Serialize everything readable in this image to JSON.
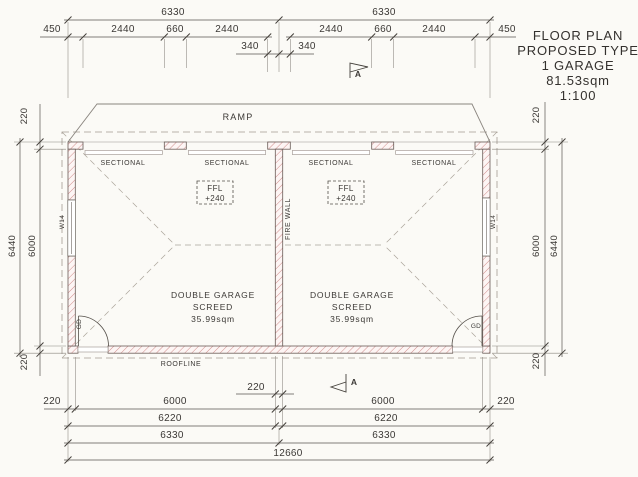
{
  "title_block": {
    "lines": [
      "FLOOR PLAN",
      "PROPOSED TYPE",
      "1 GARAGE",
      "81.53sqm",
      "1:100"
    ]
  },
  "plan": {
    "ramp": "RAMP",
    "roofline": "ROOFLINE",
    "sectional": "SECTIONAL",
    "firewall": "FIRE WALL",
    "ffl": "FFL",
    "ffl_value": "+240",
    "garage_name": "DOUBLE GARAGE",
    "screed": "SCREED",
    "area": "35.99sqm",
    "window": "W14",
    "door": "GD",
    "marker": "A"
  },
  "dims": {
    "top": {
      "r1_left": "6330",
      "r1_right": "6330",
      "r2": [
        "450",
        "2440",
        "660",
        "2440",
        "2440",
        "660",
        "2440",
        "450"
      ],
      "r3_left": "340",
      "r3_right": "340"
    },
    "left": {
      "t220": "220",
      "outer": "6440",
      "inner": "6000",
      "b220": "220"
    },
    "right": {
      "t220": "220",
      "inner": "6000",
      "outer": "6440",
      "b220": "220"
    },
    "bottom": {
      "fw220": "220",
      "l220": "220",
      "l6000": "6000",
      "r6000": "6000",
      "r220": "220",
      "l6220": "6220",
      "r6220": "6220",
      "l6330": "6330",
      "r6330": "6330",
      "total": "12660"
    }
  },
  "colors": {
    "wall_hatch": "#cf8d8b",
    "line": "#55504a",
    "paper": "#fbfaf6"
  }
}
